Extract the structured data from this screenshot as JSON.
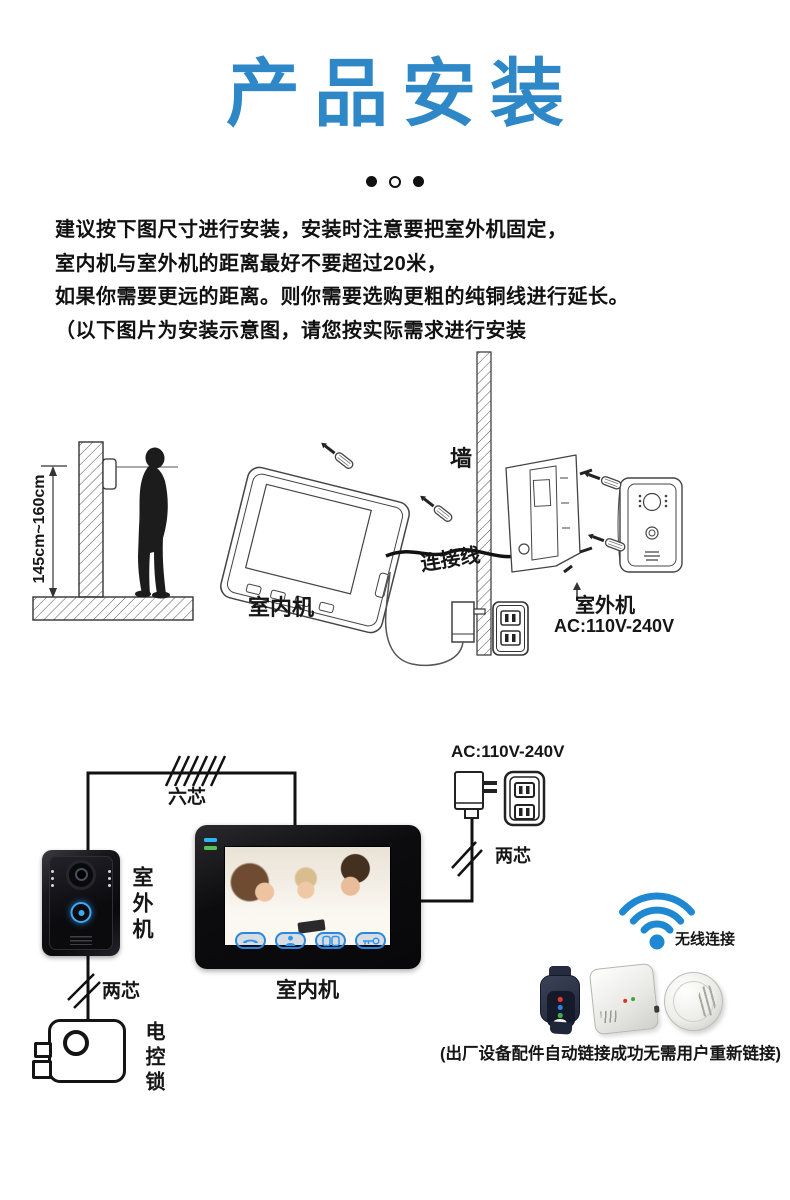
{
  "header": {
    "title": "产品安装",
    "dots": [
      "filled",
      "outline",
      "filled"
    ]
  },
  "intro": {
    "lines": [
      "建议按下图尺寸进行安装，安装时注意要把室外机固定，",
      "室内机与室外机的距离最好不要超过20米，",
      "如果你需要更远的距离。则你需要选购更粗的纯铜线进行延长。",
      "（以下图片为安装示意图，请您按实际需求进行安装"
    ]
  },
  "diagram1": {
    "height_range_label": "145cm~160cm",
    "wall_label": "墙",
    "indoor_unit_label": "室内机",
    "cable_label": "连接线",
    "outdoor_unit_label": "室外机",
    "power_label": "AC:110V-240V"
  },
  "diagram2": {
    "six_core_label": "六芯",
    "outdoor_unit_label": "室外机",
    "two_core_label_left": "两芯",
    "two_core_label_right": "两芯",
    "lock_label": "电控锁",
    "indoor_unit_label": "室内机",
    "power_label": "AC:110V-240V",
    "wireless_label": "无线连接",
    "note": "(出厂设备配件自动链接成功无需用户重新链接)"
  },
  "colors": {
    "title_blue": "#2e87c6",
    "wifi_blue": "#1e88d2",
    "touch_button_blue": "#2a87dd",
    "indicator_led_blue": "#2fb4f0",
    "indicator_led_green": "#58c05a"
  }
}
